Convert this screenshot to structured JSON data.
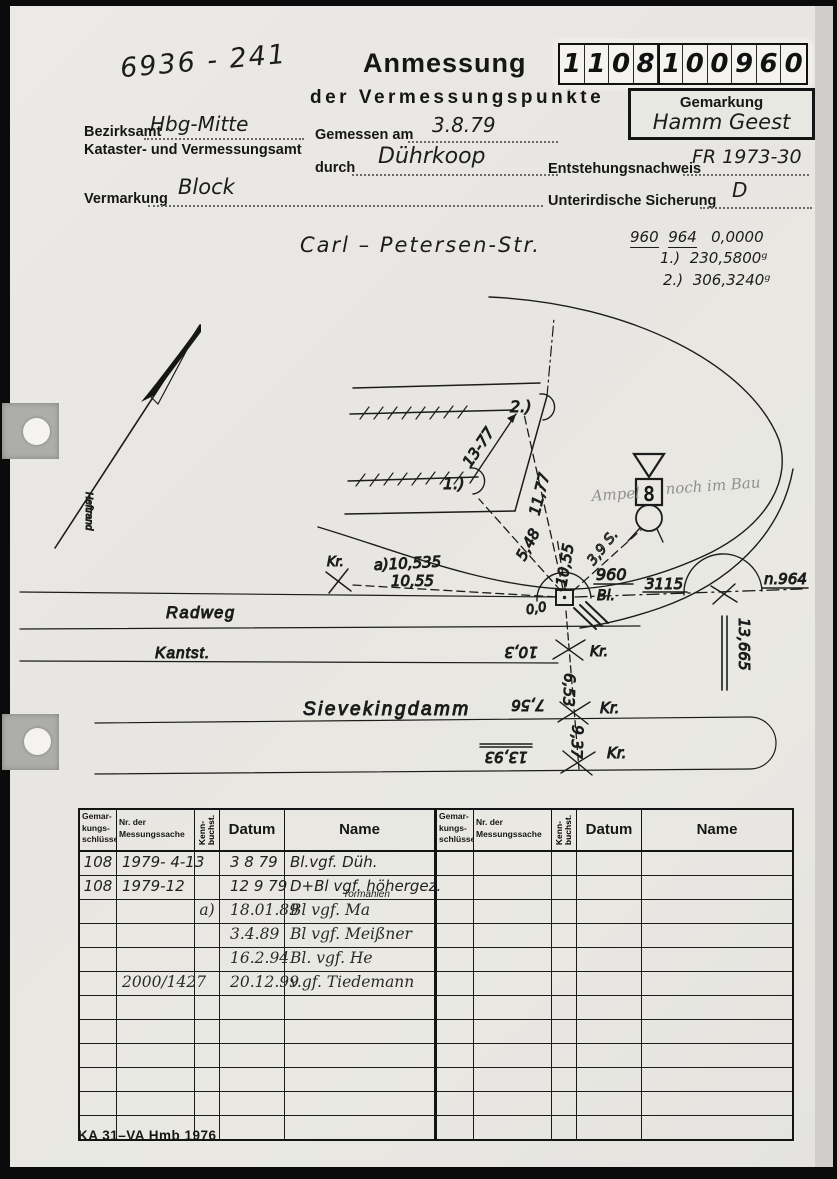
{
  "header": {
    "doc_number": "6936 - 241",
    "title": "Anmessung",
    "subtitle": "der Vermessungspunkte",
    "id_digits": [
      "1",
      "1",
      "0",
      "8",
      "1",
      "0",
      "0",
      "9",
      "6",
      "0"
    ],
    "gemarkung_label": "Gemarkung",
    "gemarkung_value": "Hamm Geest"
  },
  "form": {
    "bezirksamt_label": "Bezirksamt",
    "bezirksamt_value": "Hbg-Mitte",
    "amt_line": "Kataster- und Vermessungsamt",
    "gemessen_label": "Gemessen am",
    "gemessen_value": "3.8.79",
    "durch_label": "durch",
    "durch_value": "Dührkoop",
    "entstehung_label": "Entstehungsnachweis",
    "entstehung_value": "FR 1973-30",
    "vermarkung_label": "Vermarkung",
    "vermarkung_value": "Block",
    "sicherung_label": "Unterirdische Sicherung",
    "sicherung_value": "D"
  },
  "observations": {
    "street": "Carl – Petersen-Str.",
    "p1": "960",
    "p2": "964",
    "zero": "0,0000",
    "angle1_label": "1.)",
    "angle1": "230,5800ᵍ",
    "angle2_label": "2.)",
    "angle2": "306,3240ᵍ"
  },
  "sketch": {
    "heftrand": "Heftrand",
    "pt1": "1.)",
    "pt2": "2.)",
    "d1377": "13-77",
    "v548": "5,48",
    "v1177": "11,77",
    "v1055ray": "10,55",
    "kr": "Kr.",
    "a1": "a)10,535",
    "a2": "10,55",
    "p960": "960",
    "bl": "Bl.",
    "zz": "0,0",
    "d3115": "3115",
    "n964": "n.964",
    "v13665": "13,665",
    "ampel1": "Ampel",
    "ampel2": "noch im Bau",
    "pencil_s": "3,9 S.",
    "eight": "8",
    "radweg": "Radweg",
    "kantst": "Kantst.",
    "sieveking": "Sievekingdamm",
    "v103": "10,3",
    "v653": "6,53",
    "v756": "7,56",
    "v937": "9,37",
    "v1393": "13,93"
  },
  "table": {
    "col1": [
      "Gemar-",
      "kungs-",
      "schlüssel"
    ],
    "col2": [
      "Nr. der",
      "Messungssache"
    ],
    "col3": "Kenn-\nbuchst.",
    "col4": "Datum",
    "col5": "Name",
    "left_rows": [
      [
        "108",
        "1979- 4-13",
        "",
        "3  8 79",
        "Bl.vgf. Düh."
      ],
      [
        "108",
        "1979-12",
        "",
        "12 9 79",
        {
          "t": "D+Bl vgf.  höhergez.",
          "note": "Tormählen"
        }
      ],
      [
        "",
        "",
        "a)",
        "18.01.89",
        "Bl vgf.   Ma"
      ],
      [
        "",
        "",
        "",
        "3.4.89",
        "Bl vgf.   Meißner"
      ],
      [
        "",
        "",
        "",
        "16.2.94",
        "Bl. vgf.  He"
      ],
      [
        "",
        "2000/1427",
        "",
        "20.12.99",
        "v.gf. Tiedemann"
      ],
      [
        "",
        "",
        "",
        "",
        ""
      ],
      [
        "",
        "",
        "",
        "",
        ""
      ],
      [
        "",
        "",
        "",
        "",
        ""
      ],
      [
        "",
        "",
        "",
        "",
        ""
      ],
      [
        "",
        "",
        "",
        "",
        ""
      ],
      [
        "",
        "",
        "",
        "",
        ""
      ]
    ],
    "right_rows": [
      [
        "",
        "",
        "",
        "",
        ""
      ],
      [
        "",
        "",
        "",
        "",
        ""
      ],
      [
        "",
        "",
        "",
        "",
        ""
      ],
      [
        "",
        "",
        "",
        "",
        ""
      ],
      [
        "",
        "",
        "",
        "",
        ""
      ],
      [
        "",
        "",
        "",
        "",
        ""
      ],
      [
        "",
        "",
        "",
        "",
        ""
      ],
      [
        "",
        "",
        "",
        "",
        ""
      ],
      [
        "",
        "",
        "",
        "",
        ""
      ],
      [
        "",
        "",
        "",
        "",
        ""
      ],
      [
        "",
        "",
        "",
        "",
        ""
      ],
      [
        "",
        "",
        "",
        "",
        ""
      ]
    ]
  },
  "footer": "KA 31–VA Hmb 1976"
}
